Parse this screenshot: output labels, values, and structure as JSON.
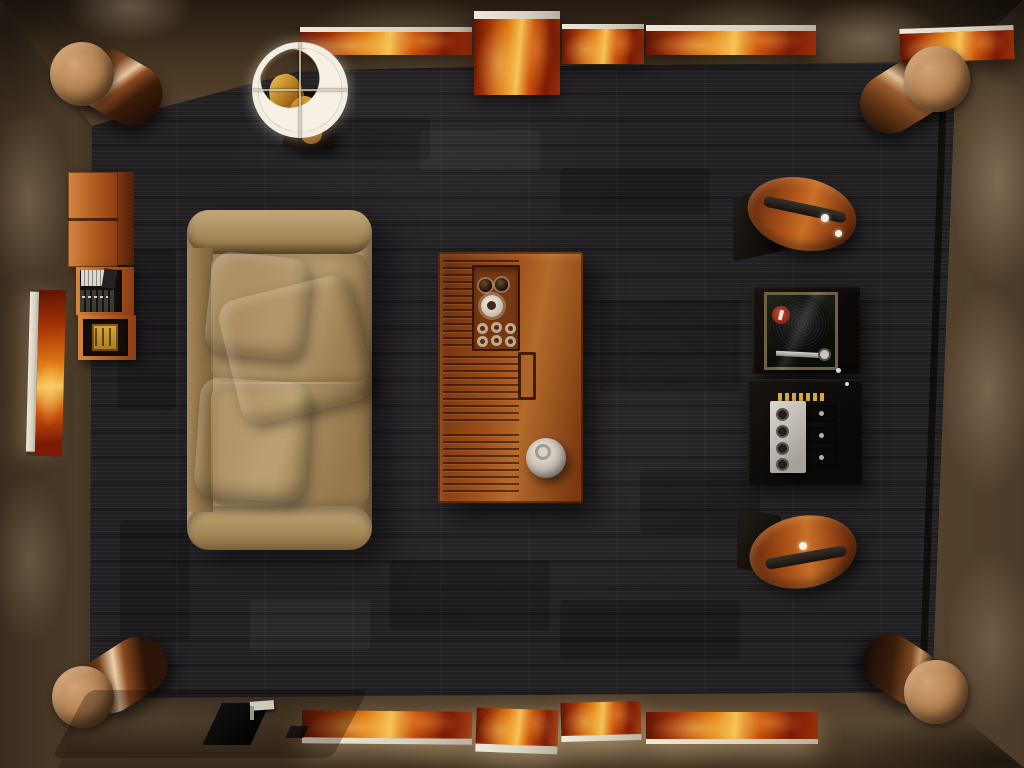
{
  "scene": {
    "title": "Top-down 3D render of a dim hi-fi listening room",
    "room": {
      "wall_lit": "#66503a",
      "wall_dark": "#241a10",
      "carpet": "#232124",
      "floor": "#57452f",
      "wood_accent": "#a5551d",
      "copper_accent": "#8a4d22",
      "art_palette": [
        "#5e1404",
        "#a33207",
        "#e07b12",
        "#f6c254",
        "#efe9da"
      ]
    },
    "objects": {
      "sofa": {
        "label": "Beige fabric sofa with two seat cushions and three throw pillows",
        "color": "#ab8a5c"
      },
      "coffee_table": {
        "label": "Slatted wooden coffee table",
        "color": "#9d4f1b"
      },
      "serving_tray": {
        "label": "Recessed tray with two dark glasses, a white cup and six empty glasses"
      },
      "bowl": {
        "label": "White ceramic bowl on table corner",
        "color": "#d8d2c6"
      },
      "shelf": {
        "label": "Cherry wood wall shelf with closed cabinet, media spines and amber box",
        "color": "#b05a20"
      },
      "pendant_lamp": {
        "label": "White ring pendant lamp with cross wires above a gold sculpture on a dark side table",
        "color": "#f3eee1"
      },
      "turntable": {
        "label": "Framed vinyl record display with red label and silver tonearm"
      },
      "amplifier": {
        "label": "Black amplifier with silver faceplate, four knobs, heatsinks and gold connectors"
      },
      "wedge_speaker_upper": {
        "label": "Teardrop wooden speaker on black base, upper right"
      },
      "wedge_speaker_lower": {
        "label": "Teardrop wooden speaker on black base, lower right"
      },
      "corner_speaker_tl": {
        "label": "Cylindrical copper speaker with cork cap, top-left corner",
        "color": "#8a4d22"
      },
      "corner_speaker_tr": {
        "label": "Cylindrical copper speaker with cork cap, top-right corner",
        "color": "#8a4d22"
      },
      "corner_speaker_bl": {
        "label": "Cylindrical copper speaker with cork cap, bottom-left corner",
        "color": "#8a4d22"
      },
      "corner_speaker_br": {
        "label": "Cylindrical copper speaker with cork cap, bottom-right corner",
        "color": "#8a4d22"
      },
      "art_top_row": {
        "label": "Row of five fiery abstract canvases leaning on the top wall ledge",
        "count": 5
      },
      "art_bottom_row": {
        "label": "Row of four fiery abstract canvases leaning on the bottom wall, lit from below",
        "count": 4
      },
      "art_left": {
        "label": "Vertical fiery abstract canvas leaning on the left wall"
      },
      "floor_hatch": {
        "label": "Black floor cable hatch with silver connector, bottom left"
      },
      "carpet": {
        "label": "Dark charcoal striped carpet"
      }
    }
  }
}
